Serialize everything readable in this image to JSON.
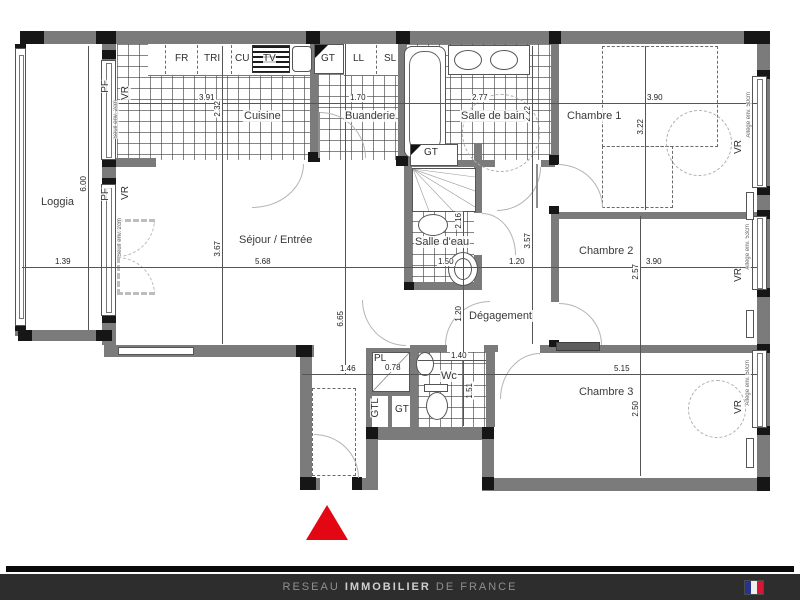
{
  "plan": {
    "colors": {
      "wall": "#7b7b7b",
      "post_black": "#161616",
      "entrance_marker_red": "#e30613",
      "footer_bg": "#2d2d2d",
      "footer_text_dim": "#8f8f8f",
      "footer_text_bright": "#cfcfcf",
      "flag_blue": "#26348b",
      "flag_white": "#eeeeee",
      "flag_red": "#da1433"
    },
    "rooms": {
      "loggia": {
        "name": "Loggia",
        "dims": {
          "w": "1.39",
          "h": "6.00"
        }
      },
      "cuisine": {
        "name": "Cuisine",
        "dims": {
          "w": "3.91",
          "h": "2.32"
        }
      },
      "buanderie": {
        "name": "Buanderie",
        "dims": {
          "w": "1.70"
        }
      },
      "salle_de_bain": {
        "name": "Salle de bain",
        "dims": {
          "w": "2.77",
          "h": "2.22"
        }
      },
      "chambre1": {
        "name": "Chambre 1",
        "dims": {
          "w": "3.90",
          "h": "3.22"
        }
      },
      "sejour": {
        "name": "Séjour / Entrée",
        "dims": {
          "w": "5.68",
          "h": "3.67",
          "h_total": "6.65"
        }
      },
      "salle_deau": {
        "name": "Salle d'eau",
        "dims": {
          "w": "1.50",
          "h": "2.16"
        }
      },
      "degagement": {
        "name": "Dégagement",
        "dims": {
          "w": "1.20",
          "h": "3.57",
          "h2": "1.20"
        }
      },
      "chambre2": {
        "name": "Chambre 2",
        "dims": {
          "w": "3.90",
          "h": "2.57"
        }
      },
      "chambre3": {
        "name": "Chambre 3",
        "dims": {
          "w": "5.15",
          "h": "2.50"
        }
      },
      "wc": {
        "name": "Wc",
        "dims": {
          "w": "1.40",
          "h": "1.51"
        }
      },
      "entree": {
        "dims": {
          "w": "1.46"
        }
      },
      "placard": {
        "name": "PL",
        "dims": {
          "w": "0.78"
        }
      }
    },
    "equipment_labels": {
      "fr": "FR",
      "tri": "TRI",
      "cu": "CU",
      "tv": "TV",
      "gt": "GT",
      "ll": "LL",
      "sl": "SL",
      "gtl": "GTL"
    },
    "window_labels": {
      "pf": "PF",
      "vr": "VR",
      "allege_50": "Allège env. 50cm",
      "allege_53": "Allège env. 53cm",
      "seuil": "Seuil env. 2cm"
    }
  },
  "footer": {
    "brand_pre": "RESEAU",
    "brand_mid": "IMMOBILIER",
    "brand_post": "DE FRANCE"
  }
}
